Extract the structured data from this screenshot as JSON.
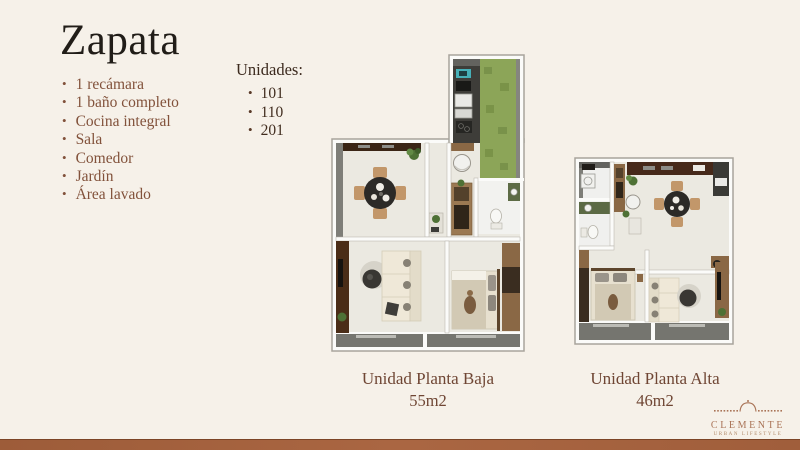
{
  "title": "Zapata",
  "features": {
    "items": [
      "1 recámara",
      "1 baño completo",
      "Cocina integral",
      "Sala",
      "Comedor",
      "Jardín",
      "Área lavado"
    ]
  },
  "unidades": {
    "heading": "Unidades:",
    "items": [
      "101",
      "110",
      "201"
    ]
  },
  "floorplans": [
    {
      "name": "Unidad Planta Baja",
      "area": "55m2"
    },
    {
      "name": "Unidad Planta Alta",
      "area": "46m2"
    }
  ],
  "logo": {
    "brand": "CLEMENTE",
    "tagline": "URBAN LIFESTYLE"
  },
  "icons": {
    "bullet": "•"
  },
  "colors": {
    "background": "#f6f1e9",
    "accent_bar": "#a2613e",
    "feature_text": "#82523b",
    "caption_text": "#6f4634",
    "logo": "#a97356"
  }
}
